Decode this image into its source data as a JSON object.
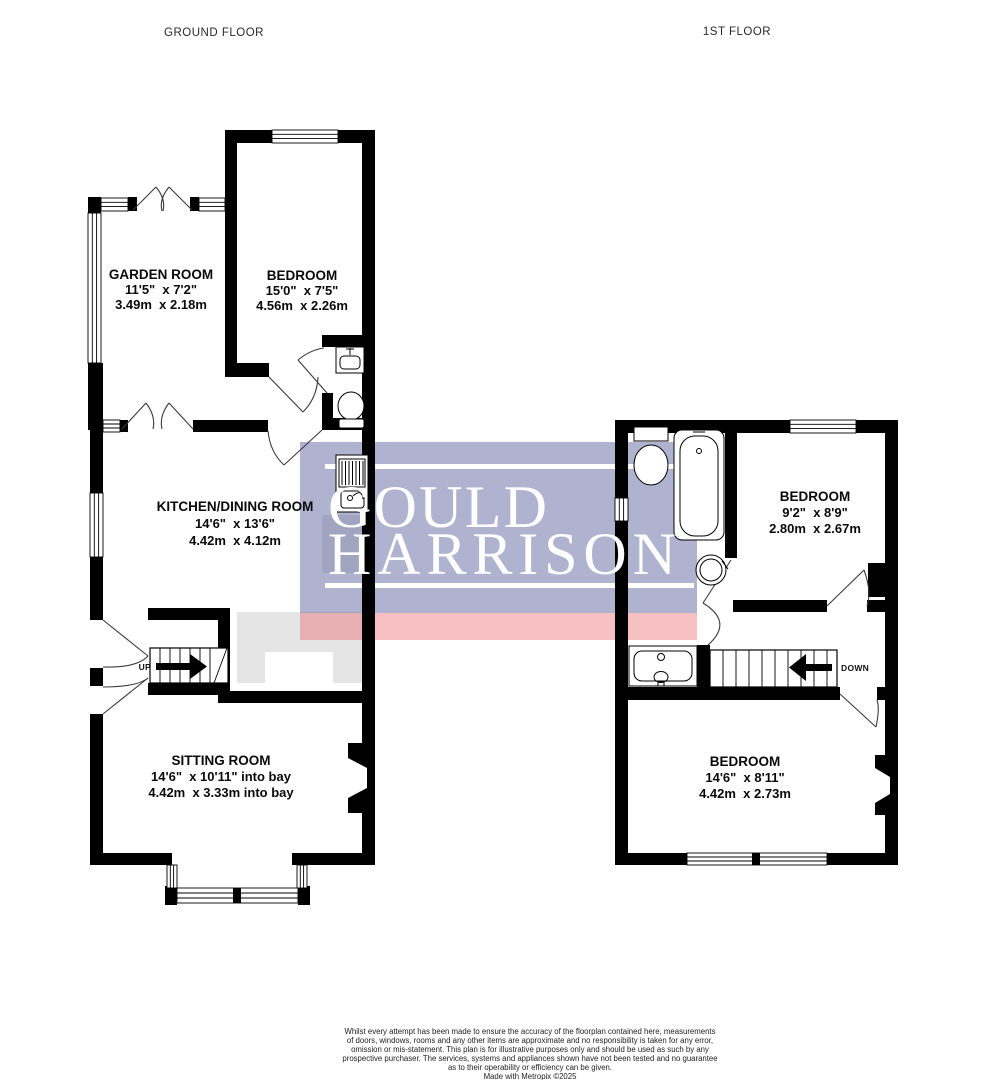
{
  "floor_titles": {
    "ground": "GROUND FLOOR",
    "first": "1ST FLOOR"
  },
  "rooms": [
    {
      "name": "GARDEN ROOM",
      "imperial": "11'5\"  x 7'2\"",
      "metric": "3.49m  x 2.18m"
    },
    {
      "name": "BEDROOM",
      "imperial": "15'0\"  x 7'5\"",
      "metric": "4.56m  x 2.26m"
    },
    {
      "name": "KITCHEN/DINING ROOM",
      "imperial": "14'6\"  x 13'6\"",
      "metric": "4.42m  x 4.12m"
    },
    {
      "name": "SITTING ROOM",
      "imperial": "14'6\"  x 10'11\" into bay",
      "metric": "4.42m  x 3.33m into bay"
    },
    {
      "name": "BEDROOM",
      "imperial": "9'2\"  x 8'9\"",
      "metric": "2.80m  x 2.67m"
    },
    {
      "name": "BEDROOM",
      "imperial": "14'6\"  x 8'11\"",
      "metric": "4.42m  x 2.73m"
    }
  ],
  "stairs": {
    "up_label": "UP",
    "down_label": "DOWN"
  },
  "logo": {
    "word1": "GOULD",
    "word2": "HARRISON",
    "panel_fill": "rgba(88,94,152,0.47)",
    "band_fill": "rgba(233,82,92,0.36)",
    "panel_color_hex": "#b0b3ce",
    "band_color_hex": "#f7c1c4",
    "text_color": "#ffffff"
  },
  "disclaimer": {
    "lines": [
      "Whilst every attempt has been made to ensure the accuracy of the floorplan contained here, measurements",
      "of doors, windows, rooms and any other items are approximate and no responsibility is taken for any error,",
      "omission or mis-statement. This plan is for illustrative purposes only and should be used as such by any",
      "prospective purchaser. The services, systems and appliances shown have not been tested and no guarantee",
      "as to their operability or efficiency can be given."
    ],
    "credit": "Made with Metropix ©2025"
  }
}
